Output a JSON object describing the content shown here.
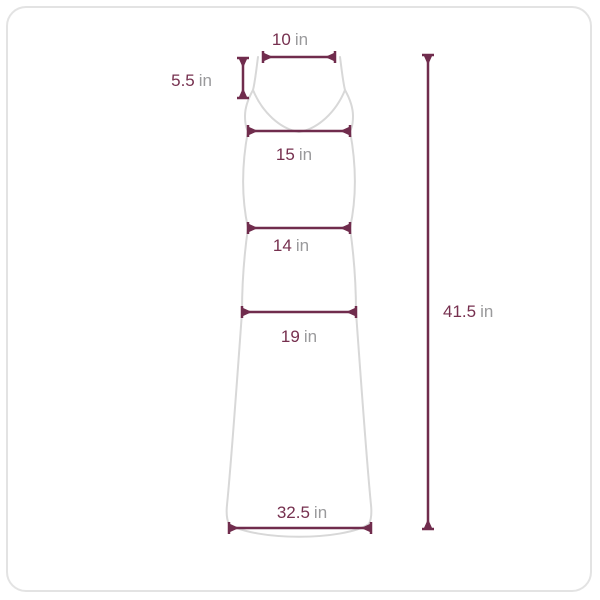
{
  "unit_label": "in",
  "measurements": {
    "top_width": "10",
    "strap_drop": "5.5",
    "bust": "15",
    "waist": "14",
    "hip": "19",
    "hem": "32.5",
    "length": "41.5"
  },
  "colors": {
    "dimension": "#702c4d",
    "value_text": "#76304f",
    "unit_text": "#9a9a9c",
    "garment_outline": "#d8d8d8",
    "card_border": "#e3e3e3",
    "background": "#ffffff"
  }
}
